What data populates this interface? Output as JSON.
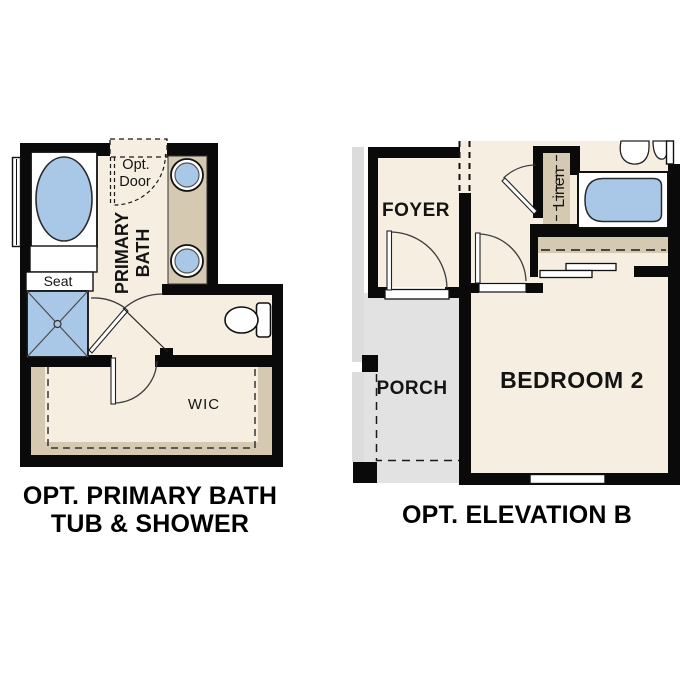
{
  "page": {
    "background": "#ffffff"
  },
  "colors": {
    "floor_cream": "#f6eee1",
    "cabinet_tan": "#d6c9b2",
    "fixture_blue": "#a9c8e7",
    "porch_grey": "#e2e2e2",
    "wall_black": "#0a0a0a"
  },
  "left_plan": {
    "caption_line1": "OPT. PRIMARY BATH",
    "caption_line2": "TUB & SHOWER",
    "labels": {
      "opt_door_line1": "Opt.",
      "opt_door_line2": "Door",
      "room_line1": "PRIMARY",
      "room_line2": "BATH",
      "seat": "Seat",
      "closet": "WIC"
    },
    "fixtures": [
      "bathtub",
      "window",
      "vanity-sink",
      "vanity-sink",
      "shower-with-seat",
      "toilet"
    ]
  },
  "right_plan": {
    "caption": "OPT. ELEVATION B",
    "labels": {
      "foyer": "FOYER",
      "porch": "PORCH",
      "bedroom": "BEDROOM 2",
      "linen": "Linen"
    },
    "fixtures": [
      "bathtub",
      "sink",
      "linen-closet",
      "bypass-closet-doors",
      "window",
      "front-door"
    ]
  }
}
